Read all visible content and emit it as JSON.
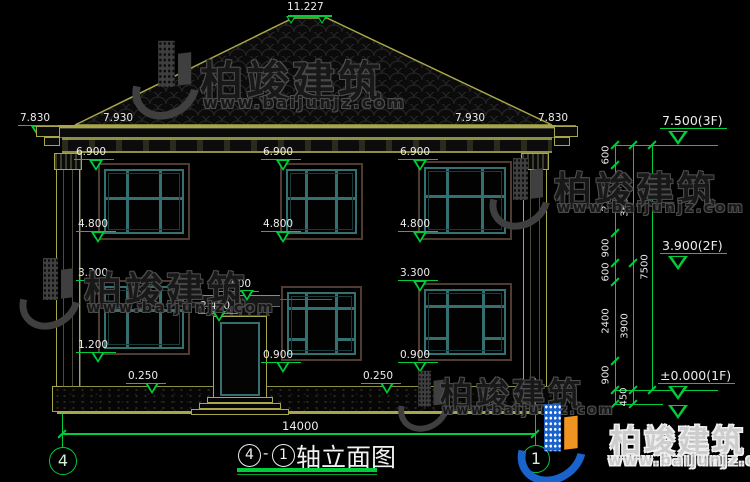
{
  "brand": {
    "name": "柏竣建筑",
    "url": "www.baijunjz.com"
  },
  "title_bar": {
    "axis_a": "4",
    "dash": "-",
    "axis_b": "1",
    "label": "轴立面图"
  },
  "axes": {
    "left": "4",
    "right": "1"
  },
  "dims": {
    "ridge": "11.227",
    "eave_outer": "7.830",
    "eave_inner": "7.930",
    "eave_level": "6.900",
    "f2_sill": "4.800",
    "f1_head": "3.300",
    "canopy_top": "3.000",
    "canopy_bottom": "2.400",
    "f1_sill_left": "1.200",
    "f1_sill": "0.900",
    "plinth": "0.250",
    "total_width": "14000"
  },
  "story_levels": {
    "f3": "7.500(3F)",
    "f2": "3.900(2F)",
    "f1": "±0.000(1F)"
  },
  "chain": {
    "seg1": "600",
    "seg2": "2100",
    "seg3": "900",
    "seg4": "600",
    "seg5": "2400",
    "seg6": "900",
    "below": "450",
    "upper_floor": "3600",
    "lower_floor": "3900",
    "total": "7500"
  },
  "colors": {
    "dim_green": "#00cc3c",
    "cad_yellow": "#a8a648",
    "window_teal": "#357070",
    "logo_blue": "#1b63cc",
    "logo_orange": "#ef9420"
  }
}
